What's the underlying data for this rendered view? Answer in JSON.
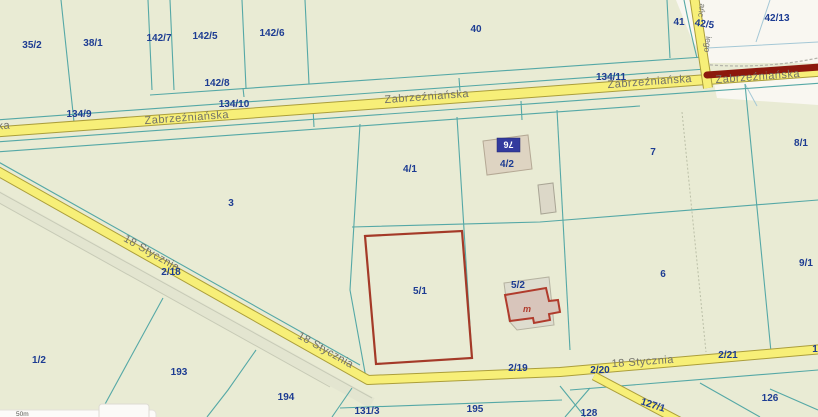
{
  "map": {
    "title": "cadastral-parcel-map",
    "scale_text": "50m",
    "address_plate": {
      "number": "76"
    },
    "building_letter": "m",
    "colors": {
      "background": "#e9ebd4",
      "parcel_line": "#55a8a6",
      "road_fill": "#f7ef78",
      "road_border": "#ab9e3b",
      "parcel_label": "#1d3c92",
      "street_label": "#71716a",
      "selected_parcel": "#a43a28",
      "highlight_bar": "#8c180d",
      "building_red": "#b03b2c",
      "building_fill": "#d8c5bb",
      "gray_building_fill": "#dcd8c8",
      "white_area": "#f9f7f1",
      "address_plate_bg": "#333a9e"
    },
    "parcel_labels": [
      {
        "text": "35/2",
        "x": 32,
        "y": 48
      },
      {
        "text": "38/1",
        "x": 93,
        "y": 46
      },
      {
        "text": "142/7",
        "x": 159,
        "y": 41
      },
      {
        "text": "142/5",
        "x": 205,
        "y": 39
      },
      {
        "text": "142/6",
        "x": 272,
        "y": 36
      },
      {
        "text": "40",
        "x": 476,
        "y": 32
      },
      {
        "text": "41",
        "x": 679,
        "y": 25
      },
      {
        "text": "42/5",
        "x": 704,
        "y": 27,
        "rot": 8
      },
      {
        "text": "42/13",
        "x": 777,
        "y": 21
      },
      {
        "text": "142/8",
        "x": 217,
        "y": 86
      },
      {
        "text": "134/11",
        "x": 611,
        "y": 80
      },
      {
        "text": "134/10",
        "x": 234,
        "y": 107
      },
      {
        "text": "134/9",
        "x": 79,
        "y": 117
      },
      {
        "text": "8/1",
        "x": 801,
        "y": 146
      },
      {
        "text": "7",
        "x": 653,
        "y": 155
      },
      {
        "text": "3",
        "x": 231,
        "y": 206
      },
      {
        "text": "4/1",
        "x": 410,
        "y": 172
      },
      {
        "text": "4/2",
        "x": 507,
        "y": 167
      },
      {
        "text": "2/18",
        "x": 171,
        "y": 275
      },
      {
        "text": "5/1",
        "x": 420,
        "y": 294
      },
      {
        "text": "5/2",
        "x": 518,
        "y": 288
      },
      {
        "text": "6",
        "x": 663,
        "y": 277
      },
      {
        "text": "9/1",
        "x": 806,
        "y": 266
      },
      {
        "text": "1/2",
        "x": 39,
        "y": 363
      },
      {
        "text": "193",
        "x": 179,
        "y": 375
      },
      {
        "text": "194",
        "x": 286,
        "y": 400
      },
      {
        "text": "2/19",
        "x": 518,
        "y": 371
      },
      {
        "text": "2/20",
        "x": 600,
        "y": 373
      },
      {
        "text": "2/21",
        "x": 728,
        "y": 358
      },
      {
        "text": "1",
        "x": 815,
        "y": 352
      },
      {
        "text": "195",
        "x": 475,
        "y": 412
      },
      {
        "text": "131/3",
        "x": 367,
        "y": 414
      },
      {
        "text": "127/1",
        "x": 652,
        "y": 408,
        "rot": 18
      },
      {
        "text": "126",
        "x": 770,
        "y": 401
      },
      {
        "text": "128",
        "x": 589,
        "y": 416
      }
    ],
    "street_labels": [
      {
        "text": "Zabrzeźniańska",
        "x": 187,
        "y": 121,
        "rot": -4.2
      },
      {
        "text": "Zabrzeźniańska",
        "x": 427,
        "y": 100,
        "rot": -4.2
      },
      {
        "text": "Zabrzeźniańska",
        "x": 650,
        "y": 85,
        "rot": -4.2
      },
      {
        "text": "Zabrzeźniańska",
        "x": 758,
        "y": 80,
        "rot": -4.2
      },
      {
        "text": "ka",
        "x": 4,
        "y": 129,
        "rot": -4
      },
      {
        "text": "18 Stycznia",
        "x": 150,
        "y": 256,
        "rot": 29.5
      },
      {
        "text": "18 Stycznia",
        "x": 324,
        "y": 353,
        "rot": 29.5
      },
      {
        "text": "18 Stycznia",
        "x": 643,
        "y": 365,
        "rot": -4
      },
      {
        "text": "ańc",
        "x": 699,
        "y": 10,
        "rot": 97,
        "frag": true
      },
      {
        "text": "iego",
        "x": 705,
        "y": 44,
        "rot": 97,
        "frag": true
      }
    ]
  }
}
